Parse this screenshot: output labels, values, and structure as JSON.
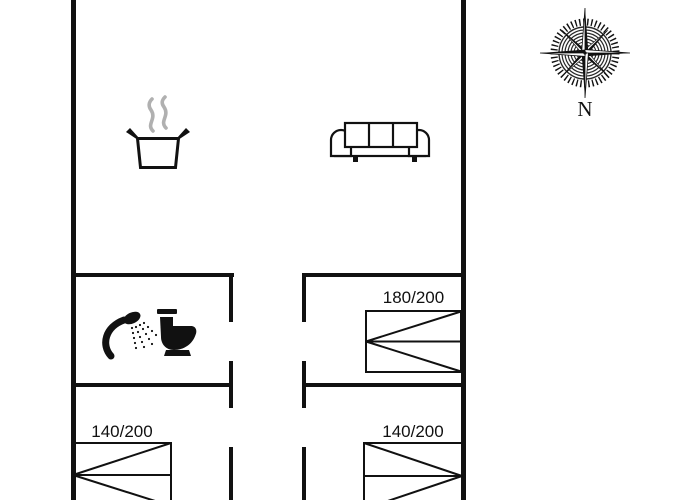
{
  "colors": {
    "line": "#111111",
    "steam": "#b0b0b0",
    "background": "#ffffff"
  },
  "compass": {
    "label": "N"
  },
  "beds": [
    {
      "label": "180/200"
    },
    {
      "label": "140/200"
    },
    {
      "label": "140/200"
    }
  ],
  "icons": {
    "kitchen": "cooking-pot-icon",
    "living_room": "sofa-icon",
    "bathroom": [
      "shower-icon",
      "toilet-icon"
    ],
    "orientation": "compass-rose-icon"
  }
}
